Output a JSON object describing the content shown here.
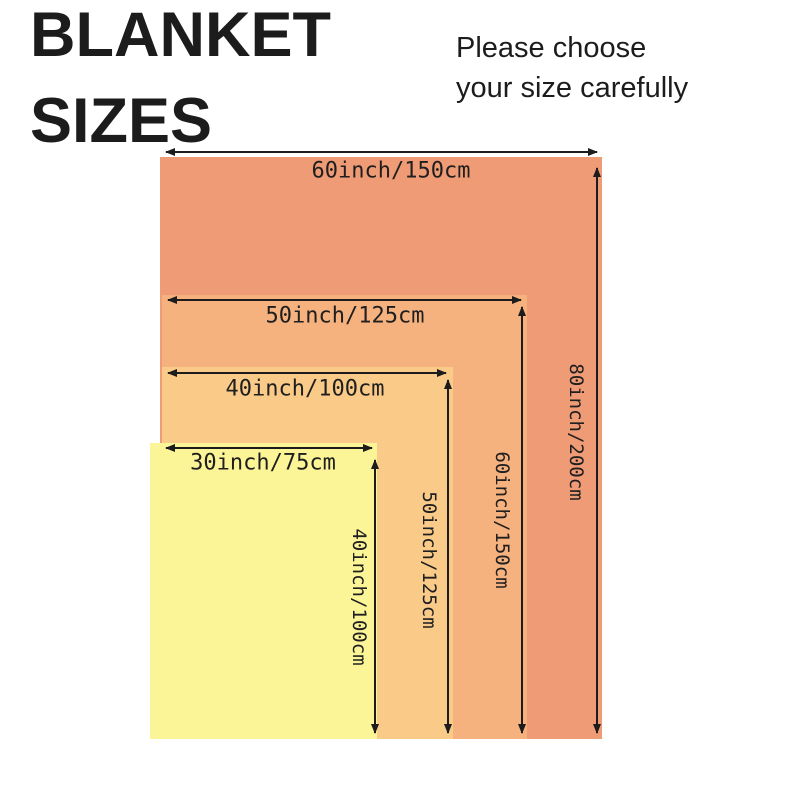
{
  "header": {
    "title_line1": "BLANKET",
    "title_line2": "SIZES",
    "subtitle_line1": "Please choose",
    "subtitle_line2": "your size carefully"
  },
  "colors": {
    "blanket_80inch": "#ef9b75",
    "blanket_60inch": "#f5b17e",
    "blanket_50inch": "#f9ca88",
    "blanket_40inch": "#fcf598",
    "arrow": "#1c1c1c",
    "label_text": "#1f1f1f",
    "title_text": "#1c1c1c",
    "background": "#ffffff"
  },
  "diagram": {
    "blankets": [
      {
        "width_label": "60inch/150cm",
        "height_label": "80inch/200cm"
      },
      {
        "width_label": "50inch/125cm",
        "height_label": "60inch/150cm"
      },
      {
        "width_label": "40inch/100cm",
        "height_label": "50inch/125cm"
      },
      {
        "width_label": "30inch/75cm",
        "height_label": "40inch/100cm"
      }
    ]
  }
}
